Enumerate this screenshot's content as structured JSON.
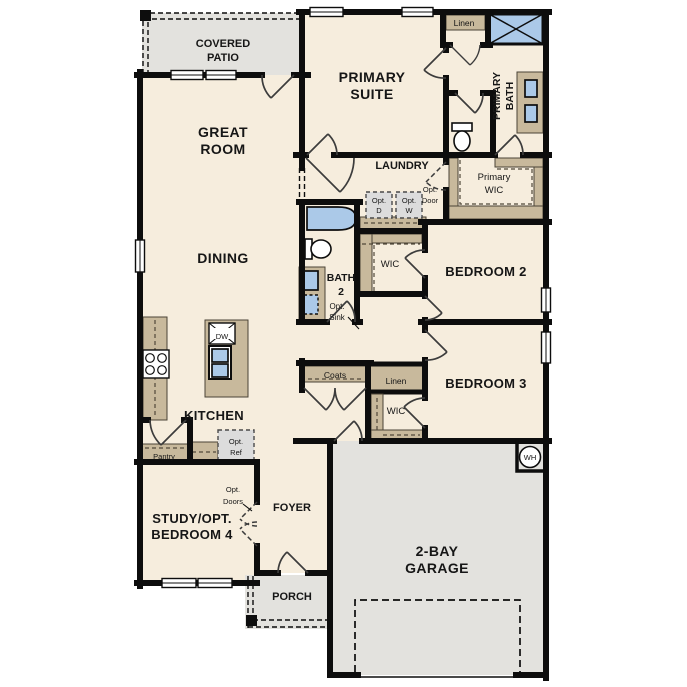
{
  "colors": {
    "wall": "#0d0d0d",
    "floor": "#f6eddd",
    "outdoor": "#e3e2de",
    "cabinet": "#c8b99c",
    "fixture": "#abc9e8",
    "appliance": "#dcdcdc"
  },
  "rooms": {
    "covered_patio": {
      "lines": [
        "COVERED",
        "PATIO"
      ]
    },
    "great_room": {
      "lines": [
        "GREAT",
        "ROOM"
      ]
    },
    "primary_suite": {
      "lines": [
        "PRIMARY",
        "SUITE"
      ]
    },
    "dining": {
      "label": "DINING"
    },
    "laundry": {
      "label": "LAUNDRY"
    },
    "primary_bath": {
      "lines": [
        "PRIMARY",
        "BATH"
      ]
    },
    "primary_wic": {
      "lines": [
        "Primary",
        "WIC"
      ]
    },
    "linen_top": {
      "label": "Linen"
    },
    "bath2": {
      "lines": [
        "BATH",
        "2"
      ]
    },
    "opt_sink": {
      "lines": [
        "Opt.",
        "Sink"
      ]
    },
    "opt_dryer": {
      "lines": [
        "Opt.",
        "D"
      ]
    },
    "opt_washer": {
      "lines": [
        "Opt.",
        "W"
      ]
    },
    "opt_door": {
      "lines": [
        "Opt.",
        "Door"
      ]
    },
    "wic_bed2": {
      "label": "WIC"
    },
    "bedroom2": {
      "label": "BEDROOM 2"
    },
    "bedroom3": {
      "label": "BEDROOM 3"
    },
    "wic_bed3": {
      "label": "WIC"
    },
    "coats": {
      "label": "Coats"
    },
    "linen_hall": {
      "label": "Linen"
    },
    "kitchen": {
      "label": "KITCHEN"
    },
    "dishwasher": {
      "label": "DW"
    },
    "pantry": {
      "label": "Pantry"
    },
    "opt_ref": {
      "lines": [
        "Opt.",
        "Ref"
      ]
    },
    "opt_doors": {
      "lines": [
        "Opt.",
        "Doors"
      ]
    },
    "study": {
      "lines": [
        "STUDY/OPT.",
        "BEDROOM 4"
      ]
    },
    "foyer": {
      "label": "FOYER"
    },
    "porch": {
      "label": "PORCH"
    },
    "garage": {
      "lines": [
        "2-BAY",
        "GARAGE"
      ]
    },
    "water_heater": {
      "label": "WH"
    }
  }
}
